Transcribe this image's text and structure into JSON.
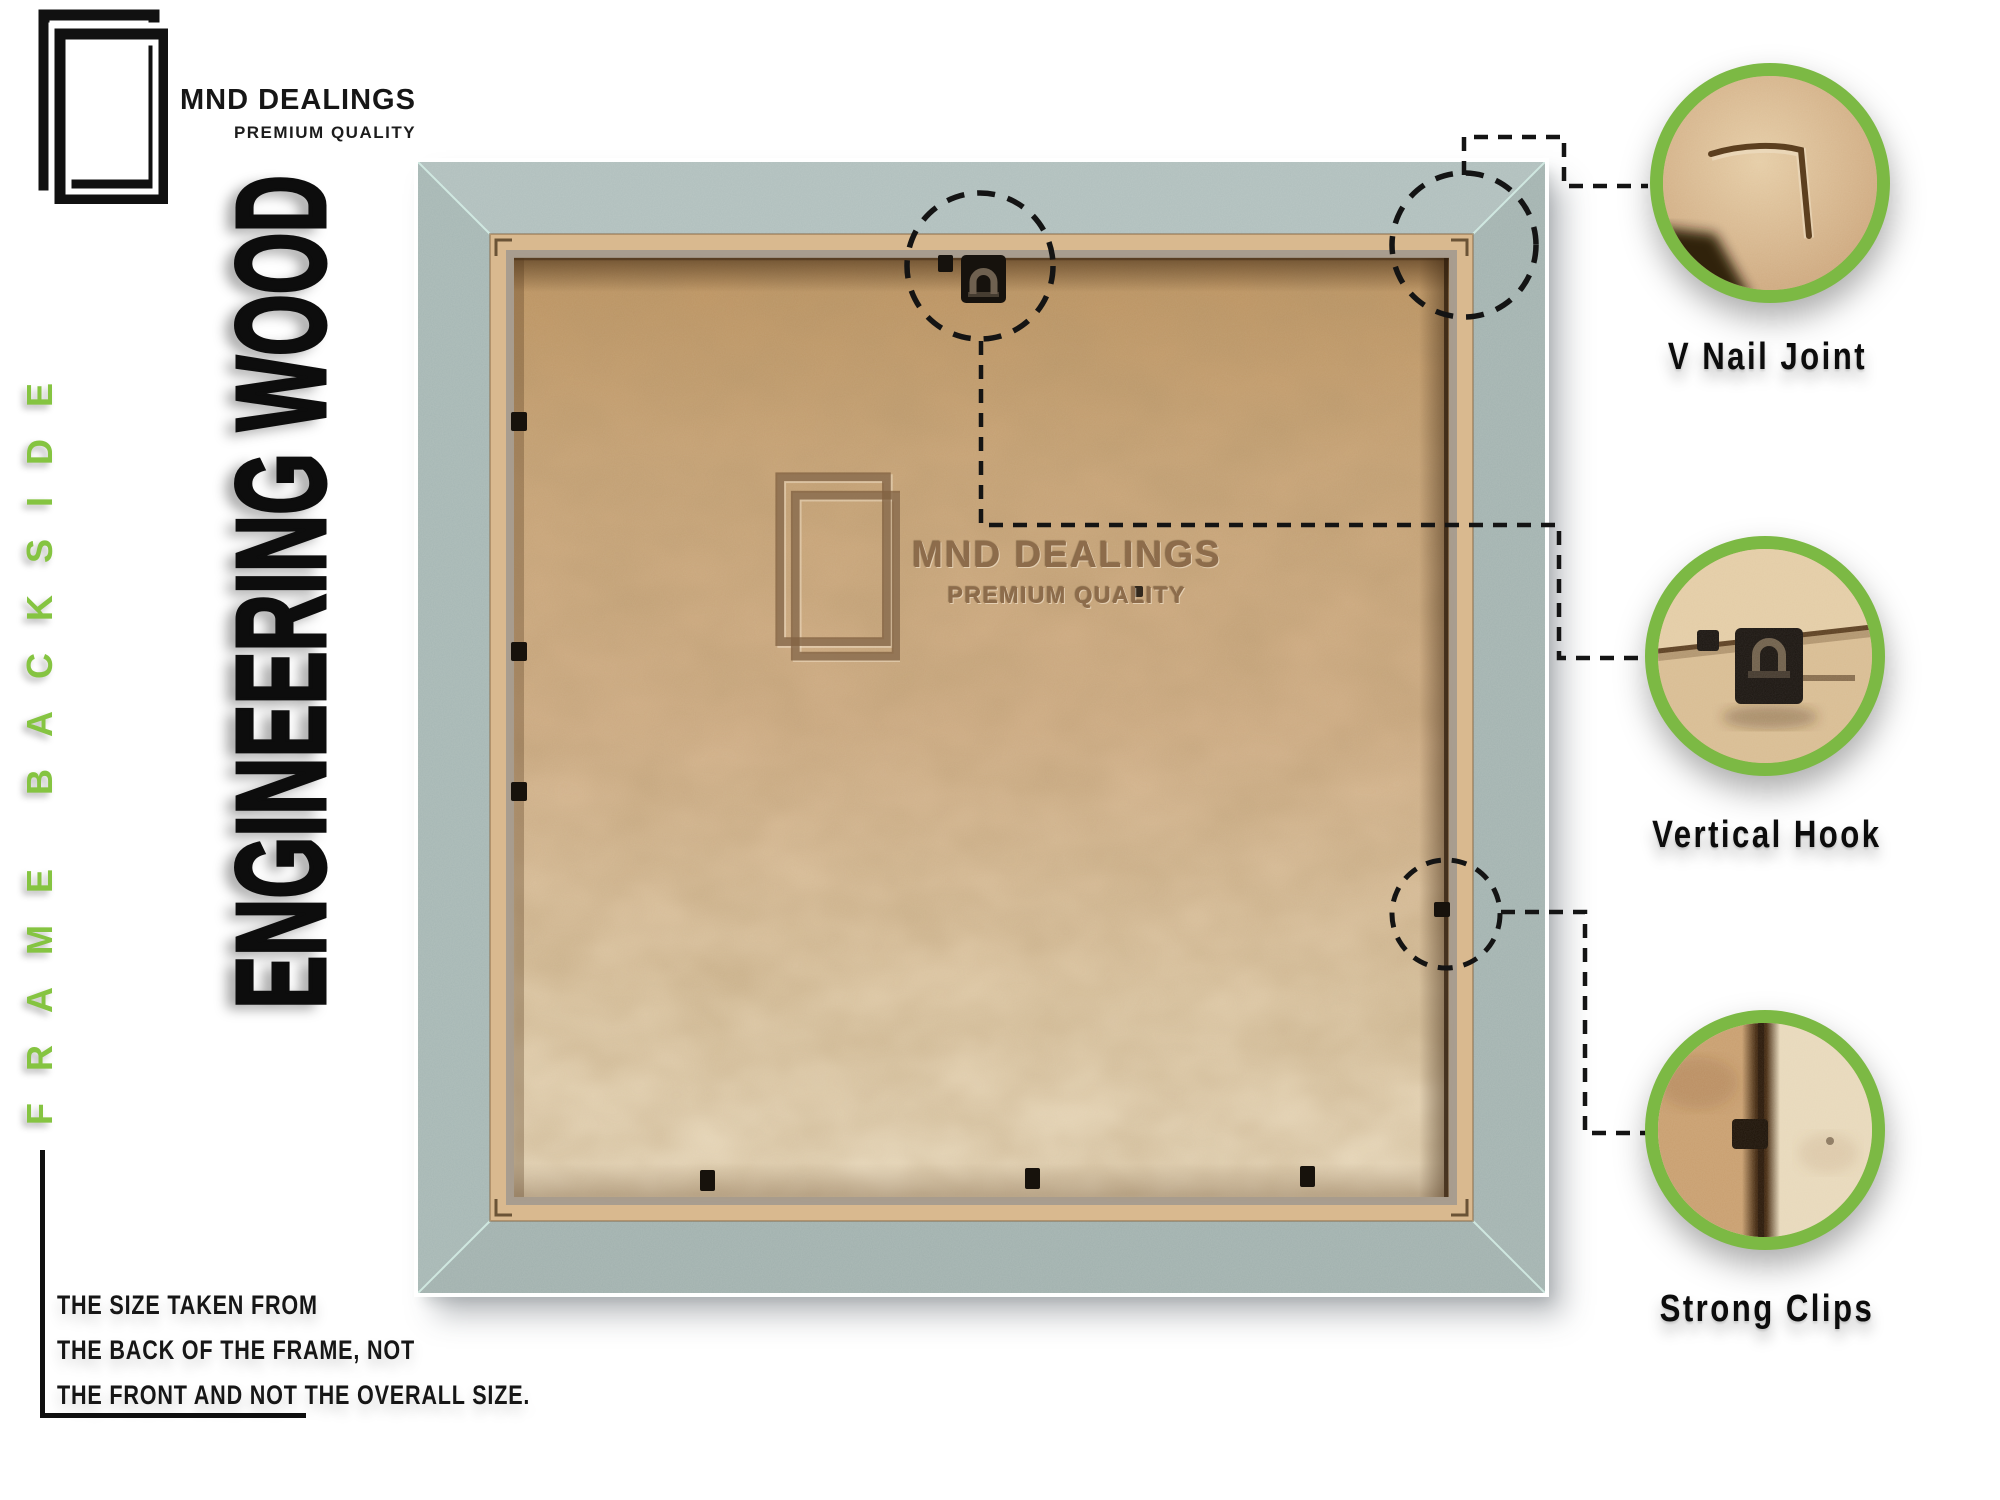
{
  "brand": {
    "name": "MND DEALINGS",
    "tagline": "PREMIUM QUALITY",
    "logo_icon": "overlapping-frames-icon"
  },
  "side_label": "FRAME BACKSIDE",
  "material_title": "ENGINEERING WOOD",
  "watermark": {
    "name": "MND DEALINGS",
    "tagline": "PREMIUM QUALITY",
    "logo_icon": "overlapping-frames-icon"
  },
  "size_note": {
    "lines": [
      "THE SIZE TAKEN FROM",
      "THE BACK OF THE FRAME, NOT",
      "THE FRONT AND NOT THE OVERALL SIZE."
    ]
  },
  "callouts": [
    {
      "label": "V Nail Joint"
    },
    {
      "label": "Vertical Hook"
    },
    {
      "label": "Strong Clips"
    }
  ],
  "colors": {
    "accent_green": "#7cb944",
    "side_label_green": "#85c441",
    "frame_gray": "#a9bab7",
    "board_tan": "#cfae87",
    "ink": "#111111"
  }
}
